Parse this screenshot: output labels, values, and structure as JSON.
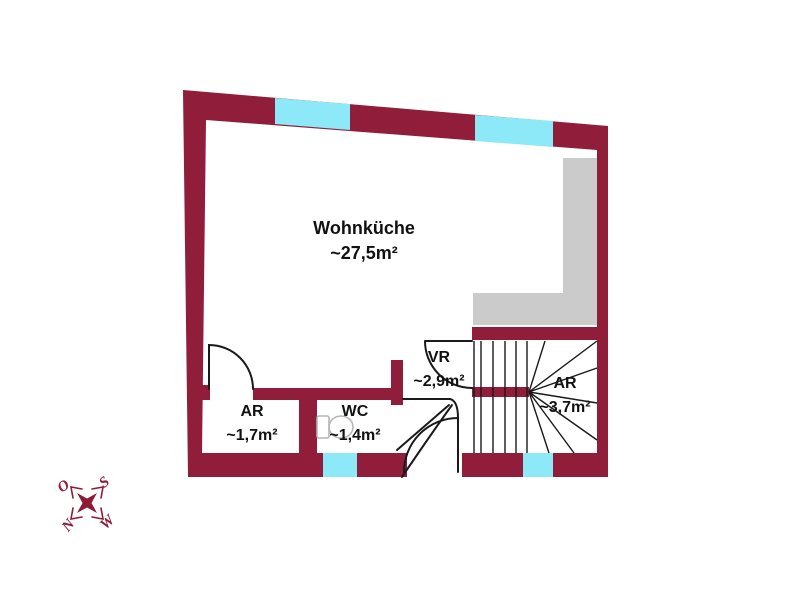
{
  "floorplan": {
    "rooms": [
      {
        "name": "Wohnküche",
        "area": "~27,5m²"
      },
      {
        "name": "AR",
        "area": "~1,7m²"
      },
      {
        "name": "WC",
        "area": "~1,4m²"
      },
      {
        "name": "VR",
        "area": "~2,9m²"
      },
      {
        "name": "AR",
        "area": "~3,7m²"
      }
    ],
    "compass": {
      "top_left": "O",
      "top_right": "S",
      "bottom_left": "N",
      "bottom_right": "W"
    },
    "colors": {
      "wall": "#901d3a",
      "window": "#8de8f8",
      "terrace": "#cbcbcb",
      "line": "#1a1a1a",
      "label": "#111111",
      "compass": "#8e1c38",
      "toilet": "#b5b5b5"
    }
  }
}
